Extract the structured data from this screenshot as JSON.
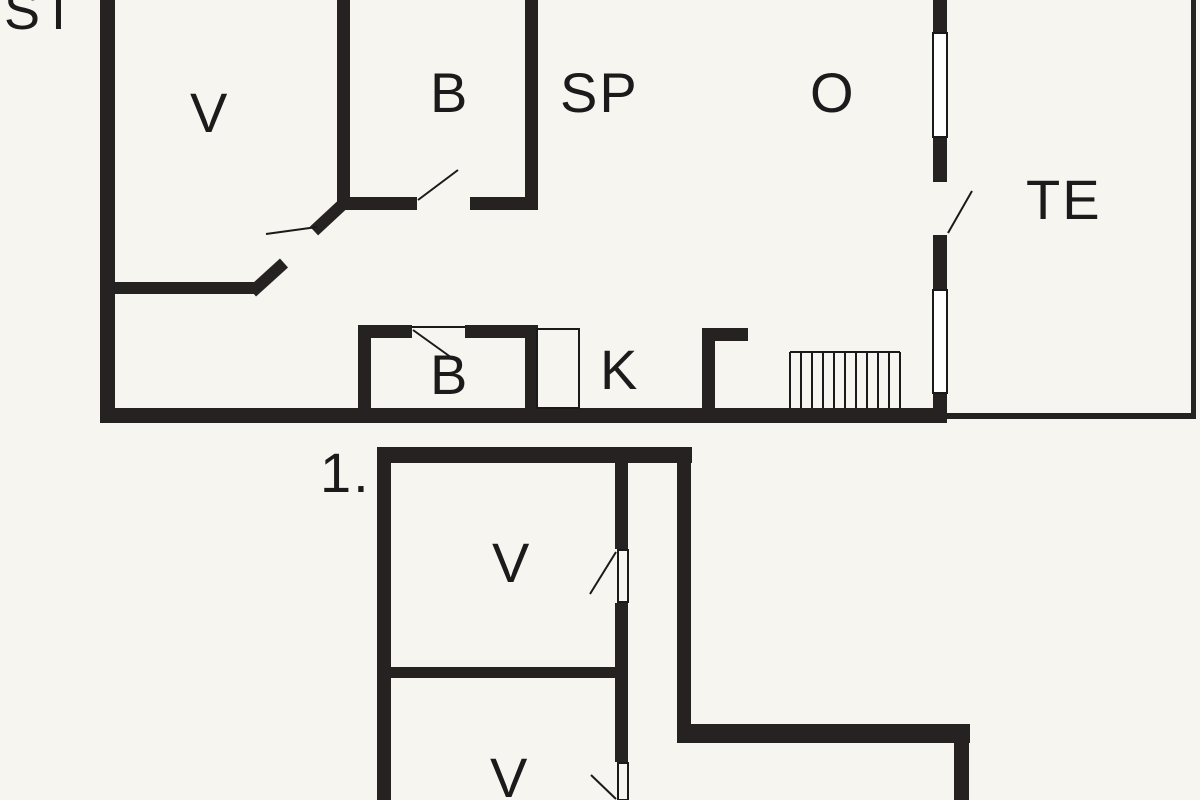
{
  "plan": {
    "type": "floor-plan",
    "colors": {
      "background": "#f6f5f0",
      "wall": "#262222",
      "line": "#1a1a1a",
      "text": "#1c1a1a"
    },
    "floors": [
      {
        "name": "ground-floor",
        "rooms": [
          "ST",
          "V",
          "B",
          "SP",
          "O",
          "TE",
          "B",
          "K"
        ]
      },
      {
        "name": "first-floor",
        "marker": "1.",
        "rooms": [
          "V",
          "V"
        ]
      }
    ]
  },
  "labels": {
    "st": "ST",
    "v_main": "V",
    "b_main": "B",
    "sp": "SP",
    "o": "O",
    "te": "TE",
    "b_small": "B",
    "k": "K",
    "floor_marker": "1.",
    "v_first_upper": "V",
    "v_first_lower": "V"
  }
}
